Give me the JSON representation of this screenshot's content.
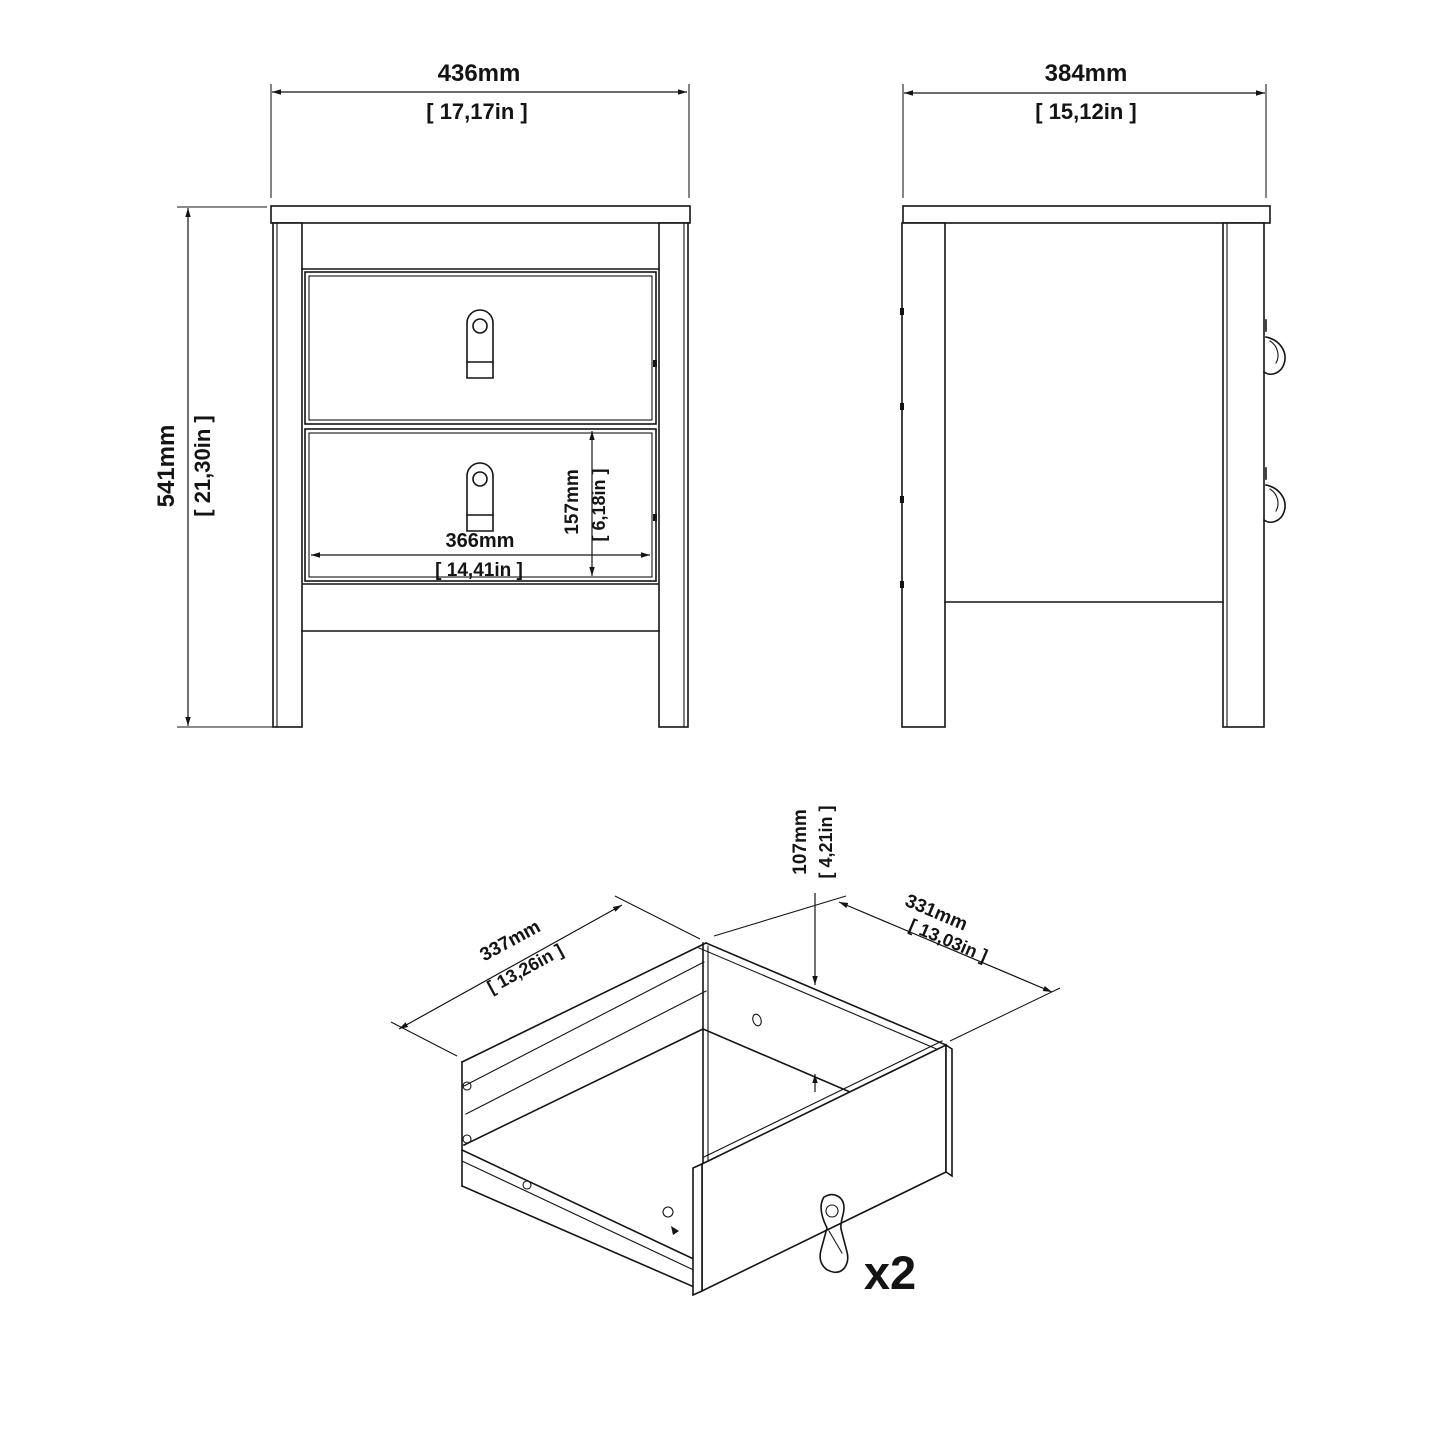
{
  "figure": {
    "type": "furniture technical drawing",
    "subject": "bedside table with two drawers",
    "line_color": "#141414",
    "background_color": "#ffffff"
  },
  "front_view": {
    "width_mm": "436mm",
    "width_in": "[ 17,17in ]",
    "height_mm": "541mm",
    "height_in": "[ 21,30in ]",
    "inner_width_mm": "366mm",
    "inner_width_in": "[ 14,41in ]",
    "drawer_front_height_mm": "157mm",
    "drawer_front_height_in": "[ 6,18in ]"
  },
  "side_view": {
    "depth_mm": "384mm",
    "depth_in": "[ 15,12in ]"
  },
  "drawer_detail": {
    "inner_width_mm": "337mm",
    "inner_width_in": "[ 13,26in ]",
    "inner_depth_mm": "331mm",
    "inner_depth_in": "[ 13,03in ]",
    "inner_height_mm": "107mm",
    "inner_height_in": "[ 4,21in ]",
    "quantity_label": "x2"
  }
}
